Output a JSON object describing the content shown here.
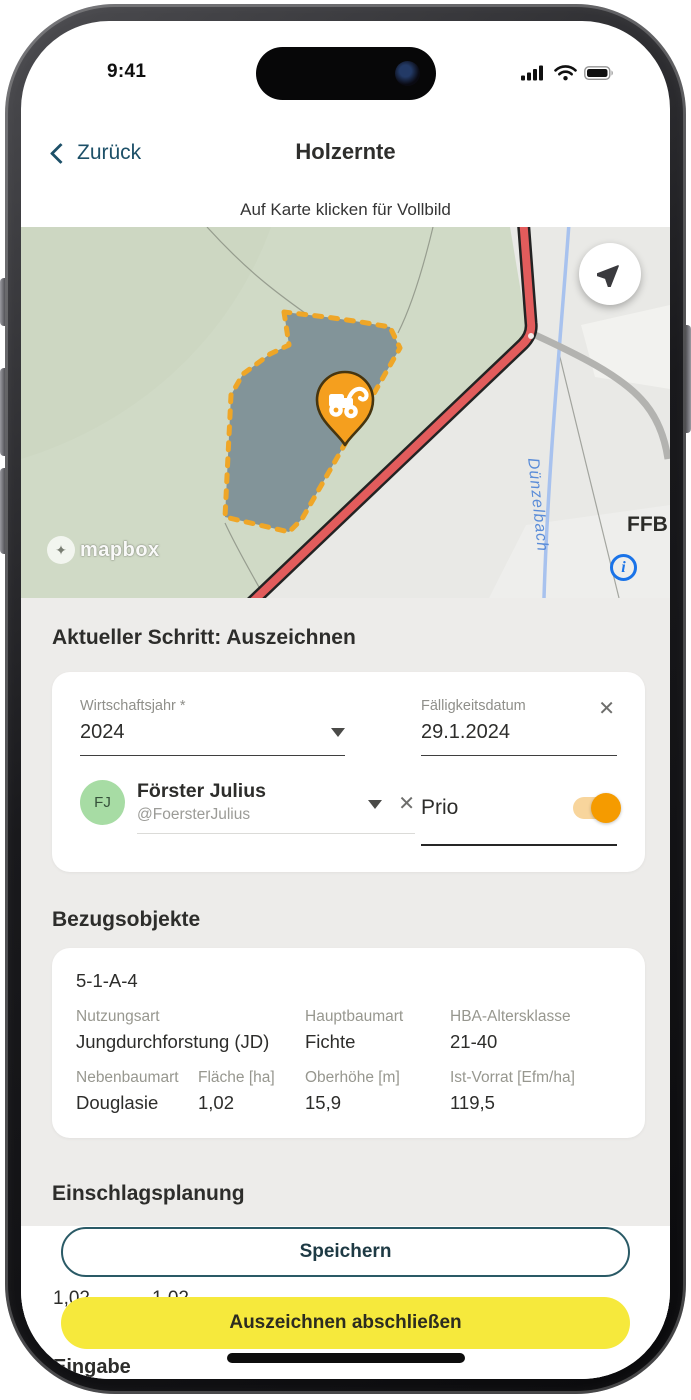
{
  "status_bar": {
    "time": "9:41"
  },
  "header": {
    "back_label": "Zurück",
    "title": "Holzernte",
    "subtitle": "Auf Karte klicken für Vollbild"
  },
  "map": {
    "attribution": "mapbox",
    "stream_label": "Dünzelbach",
    "area_label": "FFB",
    "marker": "harvester-pin",
    "polygon_fill": "#7D8F96",
    "polygon_border": "#F2A31B",
    "road_color": "#E25C5C"
  },
  "current_step": {
    "heading": "Aktueller Schritt: Auszeichnen",
    "wirtschaftsjahr": {
      "label": "Wirtschaftsjahr *",
      "value": "2024"
    },
    "faelligkeitsdatum": {
      "label": "Fälligkeitsdatum",
      "value": "29.1.2024"
    },
    "person": {
      "initials": "FJ",
      "name": "Förster Julius",
      "handle": "@FoersterJulius"
    },
    "prio": {
      "label": "Prio",
      "enabled": true,
      "on_color": "#F59B00"
    }
  },
  "bezugsobjekte": {
    "heading": "Bezugsobjekte",
    "object_id": "5-1-A-4",
    "row1": [
      {
        "label": "Nutzungsart",
        "value": "Jungdurchforstung (JD)"
      },
      {
        "label": "Hauptbaumart",
        "value": "Fichte"
      },
      {
        "label": "HBA-Altersklasse",
        "value": "21-40"
      }
    ],
    "row2": [
      {
        "label": "Nebenbaumart",
        "value": "Douglasie"
      },
      {
        "label": "Fläche [ha]",
        "value": "1,02"
      },
      {
        "label": "Oberhöhe [m]",
        "value": "15,9"
      },
      {
        "label": "Ist-Vorrat [Efm/ha]",
        "value": "119,5"
      }
    ]
  },
  "einschlagsplanung": {
    "heading": "Einschlagsplanung",
    "partial_values": [
      "1,02",
      "1,02"
    ],
    "partial_label": "Eingabe"
  },
  "footer": {
    "save_label": "Speichern",
    "finish_label": "Auszeichnen abschließen",
    "accent_yellow": "#F6E93C",
    "accent_teal": "#2A5A66"
  }
}
